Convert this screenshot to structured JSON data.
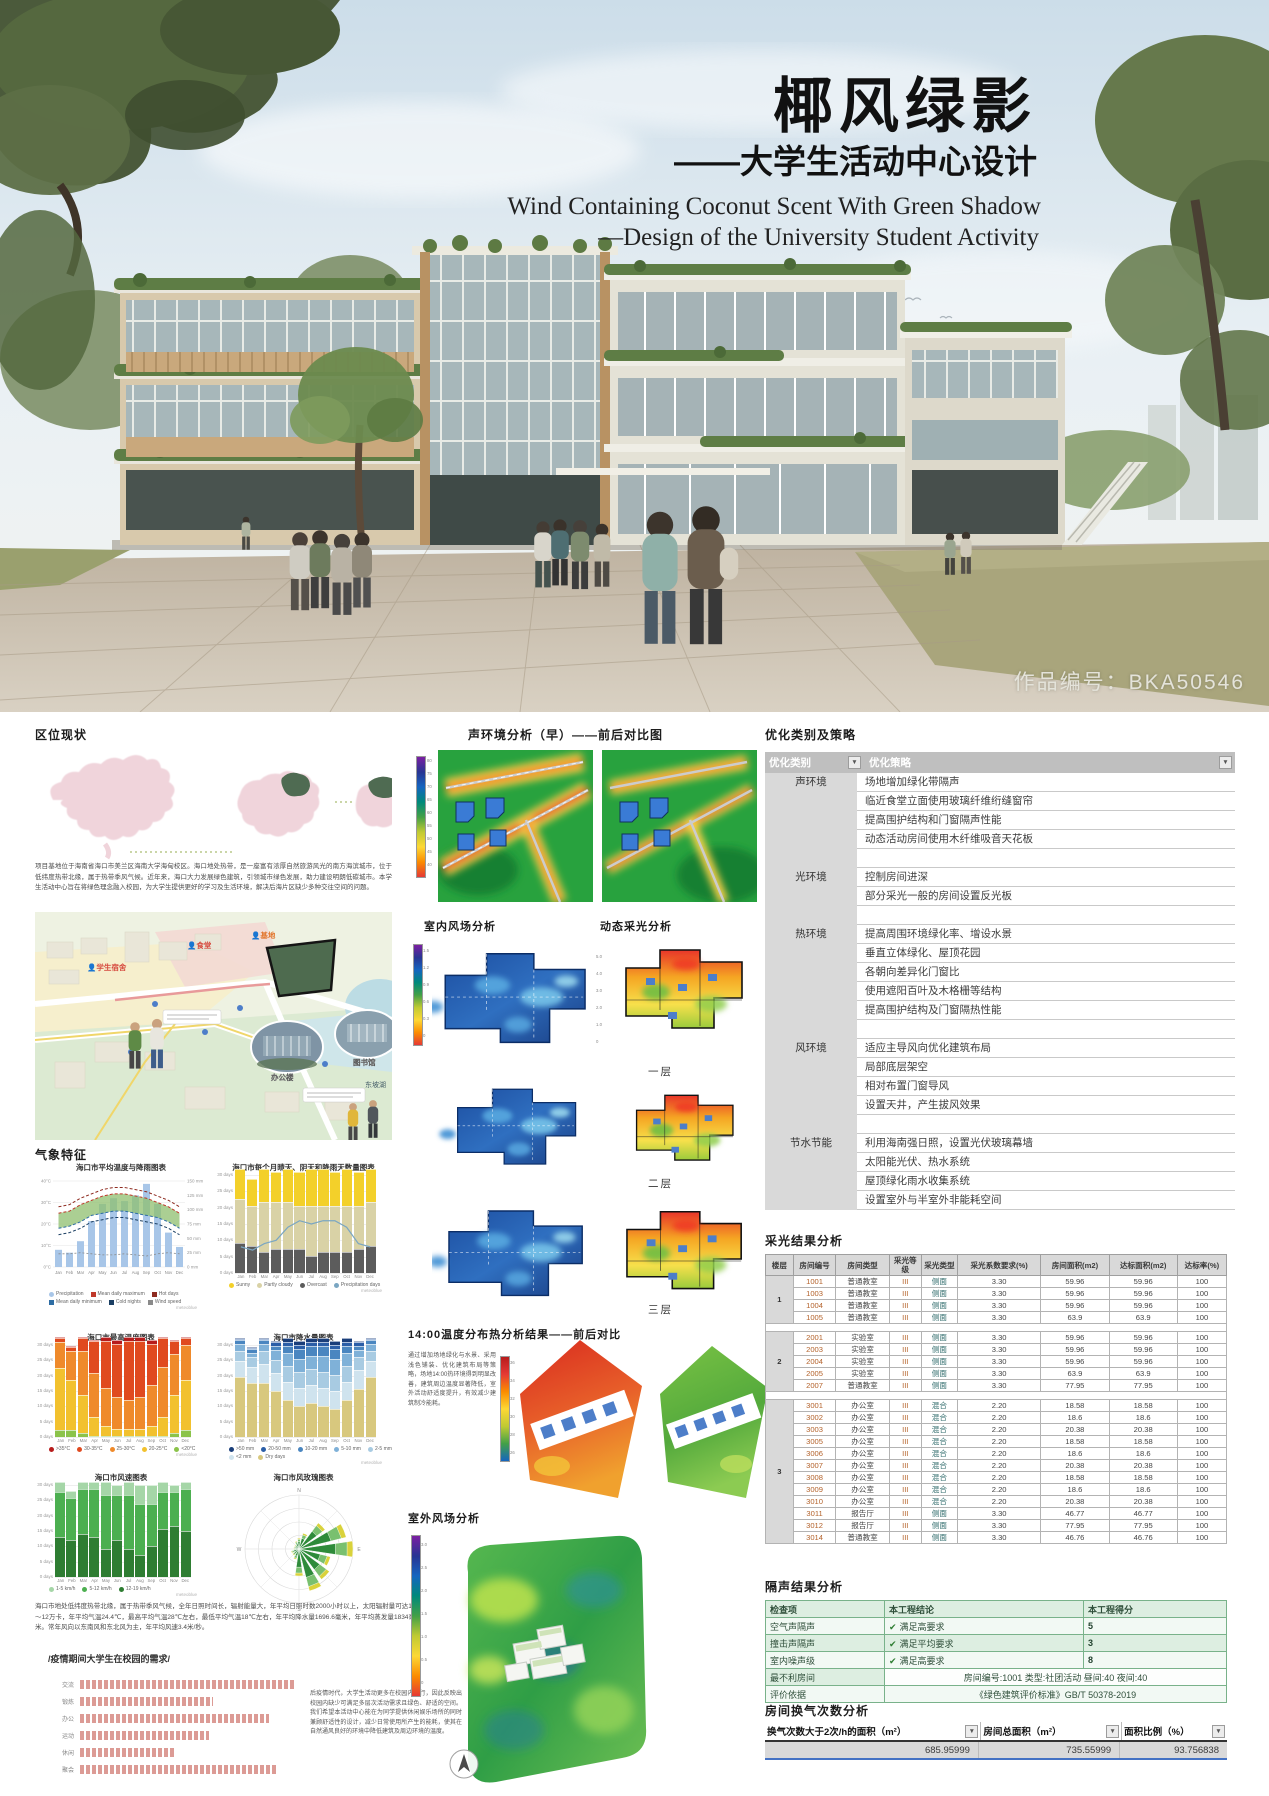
{
  "poster": {
    "title_cn": "椰风绿影",
    "subtitle_cn": "——大学生活动中心设计",
    "title_en_line1": "Wind Containing Coconut Scent With Green Shadow",
    "title_en_line2": "—Design of the University Student Activity",
    "work_no": "作品编号：BKA50546"
  },
  "left": {
    "location_title": "区位现状",
    "location_paragraph": "项目基地位于海南省海口市美兰区海南大学海甸校区。海口地处热带，是一座富有浓厚自然旅游风光的南方海滨城市，位于低纬度热带北缘，属于热带季风气候。近年来，海口大力发展绿色建筑，引领城市绿色发展，助力建设明朗低碳城市。本学生活动中心旨在将绿色理念融入校园，为大学生提供更好的学习及生活环境，解决后海片区缺少多种交往空间的问题。",
    "site_labels": {
      "dorm": "学生宿舍",
      "canteen": "食堂",
      "site": "基地",
      "office": "办公楼",
      "library": "图书馆",
      "lake": "东坡湖"
    },
    "climate_title": "气象特征",
    "climate_paragraph": "海口市地处低纬度热带北缘，属于热带季风气候，全年日照时间长，辐射能量大，年平均日照时数2000小时以上，太阳辐射量可达11～12万卡，年平均气温24.4℃，最高平均气温28℃左右，最低平均气温18℃左右，年平均降水量1696.6毫米，年平均蒸发量1834毫米。常年风向以东南风和东北风为主，年平均风速3.4米/秒。",
    "needs_title": "/疫情期间大学生在校园的需求/",
    "needs_paragraph": "后疫情时代，大学生活动更多在校园内进行，因此反映出校园内缺少可满足多层次活动需求且绿色、舒适的空间。我们希望本活动中心能在为同学提供休闲娱乐场所的同时兼顾舒适性的设计，减少日常使用所产生的能耗，使其在自然通风良好的环境中降低建筑及周边环境的温度。"
  },
  "middle": {
    "acoustic_title": "声环境分析（早）——前后对比图",
    "indoor_wind_title": "室内风场分析",
    "daylight_title": "动态采光分析",
    "floor_labels": [
      "一层",
      "二层",
      "三层"
    ],
    "temp_title": "14:00温度分布热分析结果——前后对比",
    "temp_paragraph": "通过增加场地绿化与水景、采用浅色铺装、优化建筑布局等策略，场地14:00热环境得到明显改善，建筑周边温度显著降低，室外活动舒适度提升，有效减少建筑制冷能耗。",
    "outdoor_wind_title": "室外风场分析",
    "acoustic_scale_ticks": [
      "80",
      "75",
      "70",
      "65",
      "60",
      "55",
      "50",
      "45",
      "40"
    ],
    "wind_scale_ticks": [
      "1.5",
      "1.2",
      "0.9",
      "0.6",
      "0.3",
      "0"
    ],
    "day_scale_ticks": [
      "5.0",
      "4.0",
      "3.0",
      "2.0",
      "1.0",
      "0"
    ],
    "temp_scale_ticks": [
      "36",
      "34",
      "32",
      "30",
      "28",
      "26"
    ],
    "outdoor_scale_ticks": [
      "3.0",
      "2.5",
      "2.0",
      "1.5",
      "1.0",
      "0.5",
      "0"
    ]
  },
  "right": {
    "strategy_title": "优化类别及策略",
    "strategy_table": {
      "headers": [
        "优化类别",
        "优化策略"
      ],
      "groups": [
        {
          "category": "声环境",
          "items": [
            "场地增加绿化带隔声",
            "临近食堂立面使用玻璃纤维绗缝窗帘",
            "提高围护结构和门窗隔声性能",
            "动态活动房间使用木纤维吸音天花板"
          ]
        },
        {
          "category": "光环境",
          "items": [
            "控制房间进深",
            "部分采光一般的房间设置反光板"
          ]
        },
        {
          "category": "热环境",
          "items": [
            "提高周围环境绿化率、增设水景",
            "垂直立体绿化、屋顶花园",
            "各朝向差异化门窗比",
            "使用遮阳百叶及木格栅等结构",
            "提高围护结构及门窗隔热性能"
          ]
        },
        {
          "category": "风环境",
          "items": [
            "适应主导风向优化建筑布局",
            "局部底层架空",
            "相对布置门窗导风",
            "设置天井，产生拔风效果"
          ]
        },
        {
          "category": "节水节能",
          "items": [
            "利用海南强日照，设置光伏玻璃幕墙",
            "太阳能光伏、热水系统",
            "屋顶绿化雨水收集系统",
            "设置室外与半室外非能耗空间"
          ]
        }
      ]
    },
    "daylight_result_title": "采光结果分析",
    "daylight_table": {
      "headers": [
        "楼层",
        "房间编号",
        "房间类型",
        "采光等级",
        "采光类型",
        "采光系数要求(%)",
        "房间面积(m2)",
        "达标面积(m2)",
        "达标率(%)"
      ],
      "floors": [
        {
          "floor": "1",
          "rows": [
            [
              "1001",
              "普通教室",
              "III",
              "侧面",
              "3.30",
              "59.96",
              "59.96",
              "100"
            ],
            [
              "1003",
              "普通教室",
              "III",
              "侧面",
              "3.30",
              "59.96",
              "59.96",
              "100"
            ],
            [
              "1004",
              "普通教室",
              "III",
              "侧面",
              "3.30",
              "59.96",
              "59.96",
              "100"
            ],
            [
              "1005",
              "普通教室",
              "III",
              "侧面",
              "3.30",
              "63.9",
              "63.9",
              "100"
            ]
          ]
        },
        {
          "floor": "2",
          "rows": [
            [
              "2001",
              "实验室",
              "III",
              "侧面",
              "3.30",
              "59.96",
              "59.96",
              "100"
            ],
            [
              "2003",
              "实验室",
              "III",
              "侧面",
              "3.30",
              "59.96",
              "59.96",
              "100"
            ],
            [
              "2004",
              "实验室",
              "III",
              "侧面",
              "3.30",
              "59.96",
              "59.96",
              "100"
            ],
            [
              "2005",
              "实验室",
              "III",
              "侧面",
              "3.30",
              "63.9",
              "63.9",
              "100"
            ],
            [
              "2007",
              "普通教室",
              "III",
              "侧面",
              "3.30",
              "77.95",
              "77.95",
              "100"
            ]
          ]
        },
        {
          "floor": "3",
          "rows": [
            [
              "3001",
              "办公室",
              "III",
              "混合",
              "2.20",
              "18.58",
              "18.58",
              "100"
            ],
            [
              "3002",
              "办公室",
              "III",
              "混合",
              "2.20",
              "18.6",
              "18.6",
              "100"
            ],
            [
              "3003",
              "办公室",
              "III",
              "混合",
              "2.20",
              "20.38",
              "20.38",
              "100"
            ],
            [
              "3005",
              "办公室",
              "III",
              "混合",
              "2.20",
              "18.58",
              "18.58",
              "100"
            ],
            [
              "3006",
              "办公室",
              "III",
              "混合",
              "2.20",
              "18.6",
              "18.6",
              "100"
            ],
            [
              "3007",
              "办公室",
              "III",
              "混合",
              "2.20",
              "20.38",
              "20.38",
              "100"
            ],
            [
              "3008",
              "办公室",
              "III",
              "混合",
              "2.20",
              "18.58",
              "18.58",
              "100"
            ],
            [
              "3009",
              "办公室",
              "III",
              "混合",
              "2.20",
              "18.6",
              "18.6",
              "100"
            ],
            [
              "3010",
              "办公室",
              "III",
              "混合",
              "2.20",
              "20.38",
              "20.38",
              "100"
            ],
            [
              "3011",
              "报告厅",
              "III",
              "侧面",
              "3.30",
              "46.77",
              "46.77",
              "100"
            ],
            [
              "3012",
              "报告厅",
              "III",
              "侧面",
              "3.30",
              "77.95",
              "77.95",
              "100"
            ],
            [
              "3014",
              "普通教室",
              "III",
              "侧面",
              "3.30",
              "46.76",
              "46.76",
              "100"
            ]
          ]
        }
      ]
    },
    "sound_result_title": "隔声结果分析",
    "sound_table": {
      "headers": [
        "检查项",
        "本工程结论",
        "本工程得分"
      ],
      "rows": [
        [
          "空气声隔声",
          "满足高要求",
          "5"
        ],
        [
          "撞击声隔声",
          "满足平均要求",
          "3"
        ],
        [
          "室内噪声级",
          "满足高要求",
          "8"
        ]
      ],
      "worst_room_label": "最不利房间",
      "worst_room_value": "房间编号:1001 类型:社团活动 昼间:40 夜间:40",
      "basis_label": "评价依据",
      "basis_value": "《绿色建筑评价标准》GB/T 50378-2019"
    },
    "ach_title": "房间换气次数分析",
    "ach_table": {
      "headers": [
        "换气次数大于2次/h的面积（m²）",
        "房间总面积（m²）",
        "面积比例（%）"
      ],
      "values": [
        "685.95999",
        "735.55999",
        "93.756838"
      ]
    }
  },
  "chart_data": [
    {
      "id": "temp_rain",
      "type": "bar+line",
      "title": "海口市平均温度与降雨图表",
      "x": [
        "Jan",
        "Feb",
        "Mar",
        "Apr",
        "May",
        "Jun",
        "Jul",
        "Aug",
        "Sep",
        "Oct",
        "Nov",
        "Dec"
      ],
      "precipitation_mm": [
        30,
        25,
        45,
        80,
        110,
        120,
        115,
        125,
        145,
        110,
        60,
        35
      ],
      "mean_daily_max_c": [
        25,
        26,
        29,
        31,
        33,
        34,
        34,
        33,
        32,
        30,
        28,
        25
      ],
      "mean_daily_min_c": [
        18,
        19,
        21,
        24,
        25,
        26,
        26,
        25,
        24,
        23,
        21,
        18
      ],
      "wind_speed_kmh": [
        12,
        12,
        13,
        12,
        11,
        11,
        12,
        11,
        10,
        12,
        13,
        12
      ],
      "left_axis_ticks": [
        "40°C",
        "30°C",
        "20°C",
        "10°C",
        "0°C"
      ],
      "right_axis_ticks": [
        "150",
        "125",
        "100",
        "75",
        "50",
        "25",
        "0"
      ],
      "legend": [
        "Precipitation",
        "Mean daily maximum",
        "Hot days",
        "Mean daily minimum",
        "Cold nights",
        "Wind speed"
      ]
    },
    {
      "id": "sky_days",
      "type": "stacked-bar",
      "title": "海口市每个月晴天、阴天和降雨天数量图表",
      "categories": [
        "Jan",
        "Feb",
        "Mar",
        "Apr",
        "May",
        "Jun",
        "Jul",
        "Aug",
        "Sep",
        "Oct",
        "Nov",
        "Dec"
      ],
      "ylim": [
        0,
        30
      ],
      "yticks": [
        "30 days",
        "25 days",
        "20 days",
        "15 days",
        "10 days",
        "5 days",
        "0 days"
      ],
      "series": [
        {
          "name": "Overcast",
          "color": "#5c5c5c",
          "values": [
            9,
            8,
            6,
            7,
            7,
            7,
            5,
            6,
            6,
            6,
            7,
            8
          ]
        },
        {
          "name": "Partly cloudy",
          "color": "#d9d2a6",
          "values": [
            13,
            12,
            15,
            14,
            14,
            13,
            15,
            14,
            14,
            14,
            13,
            13
          ]
        },
        {
          "name": "Sunny",
          "color": "#f3d02a",
          "values": [
            9,
            8,
            10,
            9,
            10,
            10,
            11,
            11,
            10,
            11,
            10,
            10
          ]
        }
      ],
      "line": {
        "name": "Precipitation days",
        "color": "#7aa6c2",
        "values": [
          8,
          7,
          9,
          10,
          14,
          16,
          15,
          16,
          16,
          14,
          9,
          8
        ]
      }
    },
    {
      "id": "max_temp",
      "type": "stacked-bar",
      "title": "海口市最高温度图表",
      "categories": [
        "Jan",
        "Feb",
        "Mar",
        "Apr",
        "May",
        "Jun",
        "Jul",
        "Aug",
        "Sep",
        "Oct",
        "Nov",
        "Dec"
      ],
      "ylim": [
        0,
        30
      ],
      "yticks": [
        "30 days",
        "25 days",
        "20 days",
        "15 days",
        "10 days",
        "5 days",
        "0 days"
      ],
      "series": [
        {
          "name": "<20°C",
          "color": "#8bc34a",
          "values": [
            2,
            2,
            1,
            0,
            0,
            0,
            0,
            0,
            0,
            0,
            1,
            2
          ]
        },
        {
          "name": "20-25°C",
          "color": "#f2c12e",
          "values": [
            20,
            16,
            12,
            6,
            3,
            2,
            2,
            2,
            3,
            6,
            12,
            16
          ]
        },
        {
          "name": "25-30°C",
          "color": "#ef8a2b",
          "values": [
            8,
            9,
            14,
            14,
            12,
            10,
            9,
            10,
            13,
            16,
            13,
            11
          ]
        },
        {
          "name": "30-35°C",
          "color": "#e04a1f",
          "values": [
            1,
            1,
            4,
            10,
            15,
            17,
            19,
            18,
            13,
            9,
            4,
            2
          ]
        },
        {
          "name": ">35°C",
          "color": "#b71c1c",
          "values": [
            0,
            0,
            0,
            0,
            1,
            1,
            1,
            1,
            1,
            0,
            0,
            0
          ]
        }
      ]
    },
    {
      "id": "precip_amount",
      "type": "stacked-bar",
      "title": "海口市降水量图表",
      "categories": [
        "Jan",
        "Feb",
        "Mar",
        "Apr",
        "May",
        "Jun",
        "Jul",
        "Aug",
        "Sep",
        "Oct",
        "Nov",
        "Dec"
      ],
      "ylim": [
        0,
        31
      ],
      "yticks": [
        "30 days",
        "25 days",
        "20 days",
        "15 days",
        "10 days",
        "5 days",
        "0 days"
      ],
      "series": [
        {
          "name": "Dry days",
          "color": "#d8c87e",
          "values": [
            20,
            18,
            18,
            15,
            12,
            10,
            11,
            10,
            9,
            12,
            16,
            20
          ]
        },
        {
          "name": "<2 mm",
          "color": "#cfe3ee",
          "values": [
            5,
            5,
            6,
            6,
            6,
            6,
            6,
            6,
            6,
            6,
            6,
            5
          ]
        },
        {
          "name": "2-5 mm",
          "color": "#a8cbe2",
          "values": [
            3,
            3,
            4,
            4,
            5,
            5,
            5,
            5,
            5,
            5,
            4,
            3
          ]
        },
        {
          "name": "5-10 mm",
          "color": "#7fb1d8",
          "values": [
            2,
            1,
            2,
            3,
            4,
            4,
            4,
            5,
            5,
            4,
            2,
            2
          ]
        },
        {
          "name": "10-20 mm",
          "color": "#4a86c0",
          "values": [
            1,
            1,
            1,
            1,
            2,
            3,
            3,
            3,
            3,
            2,
            1,
            1
          ]
        },
        {
          "name": "20-50 mm",
          "color": "#2b5ea7",
          "values": [
            0,
            0,
            0,
            1,
            1,
            1,
            1,
            1,
            1,
            1,
            1,
            0
          ]
        },
        {
          "name": ">50 mm",
          "color": "#1a3e7a",
          "values": [
            0,
            0,
            0,
            0,
            1,
            1,
            1,
            1,
            1,
            1,
            0,
            0
          ]
        }
      ]
    },
    {
      "id": "wind_speed",
      "type": "stacked-bar",
      "title": "海口市风速图表",
      "categories": [
        "Jan",
        "Feb",
        "Mar",
        "Apr",
        "May",
        "Jun",
        "Jul",
        "Aug",
        "Sep",
        "Oct",
        "Nov",
        "Dec"
      ],
      "ylim": [
        0,
        31
      ],
      "yticks": [
        "30 days",
        "25 days",
        "20 days",
        "15 days",
        "10 days",
        "5 days",
        "0 days"
      ],
      "series": [
        {
          "name": "12-19 km/h",
          "color": "#2e7d32",
          "values": [
            13,
            12,
            14,
            13,
            9,
            12,
            9,
            7,
            10,
            16,
            17,
            15
          ]
        },
        {
          "name": "5-12 km/h",
          "color": "#4caf50",
          "values": [
            15,
            14,
            15,
            16,
            18,
            15,
            18,
            17,
            14,
            12,
            11,
            14
          ]
        },
        {
          "name": "1-5 km/h",
          "color": "#a5d6a7",
          "values": [
            3,
            2,
            2,
            2,
            4,
            3,
            4,
            6,
            6,
            3,
            2,
            2
          ]
        }
      ]
    },
    {
      "id": "wind_rose",
      "type": "windrose",
      "title": "海口市风玫瑰图表",
      "directions": [
        "N",
        "NNE",
        "NE",
        "ENE",
        "E",
        "ESE",
        "SE",
        "SSE",
        "S",
        "SSW",
        "SW",
        "WSW",
        "W",
        "WNW",
        "NW",
        "NNW"
      ],
      "values": [
        2,
        3,
        6,
        9,
        10,
        6,
        7,
        8,
        5,
        2,
        1.5,
        1.5,
        1,
        1,
        1,
        1.5
      ],
      "compass_labels": [
        "N",
        "E",
        "S",
        "W"
      ]
    },
    {
      "id": "needs",
      "type": "hbar",
      "title": "/疫情期间大学生在校园的需求/",
      "categories": [
        "交流",
        "锻炼",
        "办公",
        "运动",
        "休闲",
        "聚会"
      ],
      "values": [
        50,
        31,
        44,
        30,
        22,
        46
      ],
      "bar_color": "#dc9b95"
    }
  ]
}
